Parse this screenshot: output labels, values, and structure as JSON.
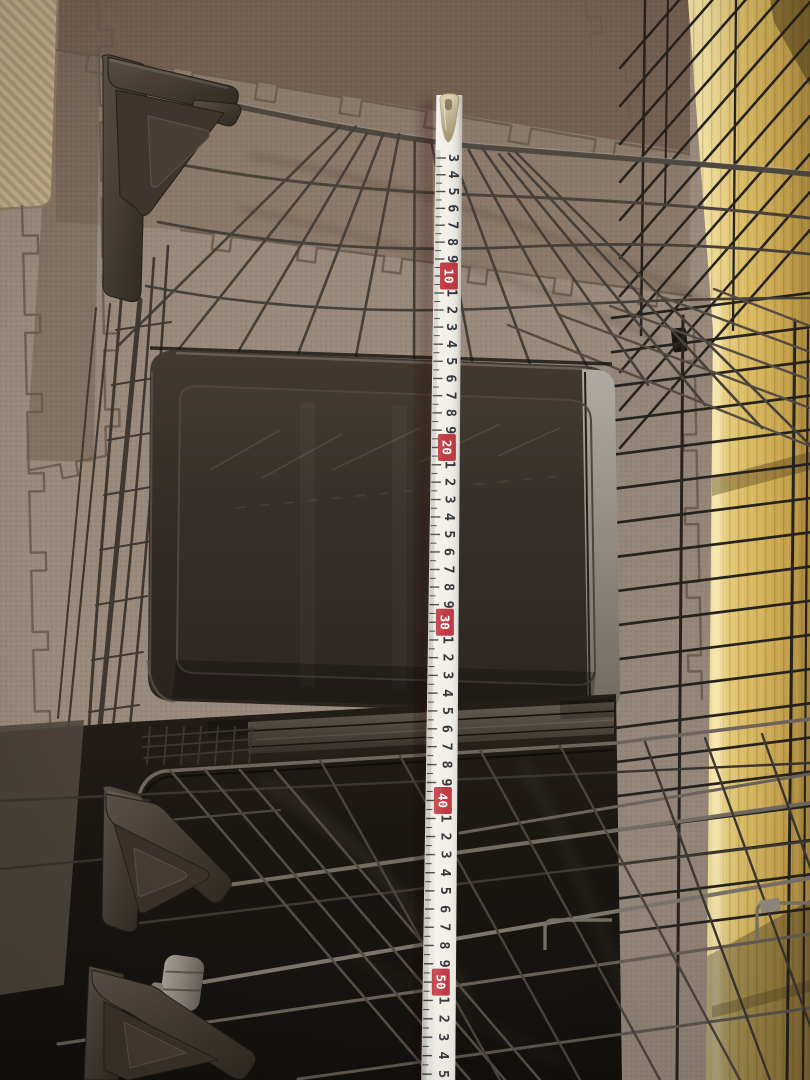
{
  "scene": {
    "kind": "photo",
    "objects": [
      "wire-pet-cage",
      "plastic-litter-tray",
      "folding-measuring-tape",
      "foam-puzzle-mats",
      "wood-panel"
    ]
  },
  "palette": {
    "mat_base": "#998a7b",
    "mat_mid": "#8b7a69",
    "mat_dark": "#746050",
    "mat_seam": "#6a5b4e",
    "woven_mat": "#c0ab89",
    "wood_light": "#f1e0a2",
    "wood_mid": "#d9ba62",
    "wood_dark": "#b3913f",
    "wire_brown": "#4f4840",
    "wire_black": "#26231f",
    "wire_metal": "#7d756a",
    "bracket_plastic": "#453b32",
    "tray_dark": "#332c26",
    "tray_edge_light": "#a8a399",
    "lower_gloss": "#1b1713",
    "tape_white": "#f3f0e9",
    "tape_red": "#c03a42",
    "tape_digit": "#35343a",
    "tape_decade_digit": "#ffffff",
    "tape_tick": "#45423c",
    "tape_tip_metal": "#c9bc98"
  },
  "tape": {
    "marks": [
      {
        "cm": 3,
        "label": "3",
        "decade": false
      },
      {
        "cm": 4,
        "label": "4",
        "decade": false
      },
      {
        "cm": 5,
        "label": "5",
        "decade": false
      },
      {
        "cm": 6,
        "label": "6",
        "decade": false
      },
      {
        "cm": 7,
        "label": "7",
        "decade": false
      },
      {
        "cm": 8,
        "label": "8",
        "decade": false
      },
      {
        "cm": 9,
        "label": "9",
        "decade": false
      },
      {
        "cm": 10,
        "label": "10",
        "decade": true
      },
      {
        "cm": 11,
        "label": "1",
        "decade": false
      },
      {
        "cm": 12,
        "label": "2",
        "decade": false
      },
      {
        "cm": 13,
        "label": "3",
        "decade": false
      },
      {
        "cm": 14,
        "label": "4",
        "decade": false
      },
      {
        "cm": 15,
        "label": "5",
        "decade": false
      },
      {
        "cm": 16,
        "label": "6",
        "decade": false
      },
      {
        "cm": 17,
        "label": "7",
        "decade": false
      },
      {
        "cm": 18,
        "label": "8",
        "decade": false
      },
      {
        "cm": 19,
        "label": "9",
        "decade": false
      },
      {
        "cm": 20,
        "label": "20",
        "decade": true
      },
      {
        "cm": 21,
        "label": "1",
        "decade": false
      },
      {
        "cm": 22,
        "label": "2",
        "decade": false
      },
      {
        "cm": 23,
        "label": "3",
        "decade": false
      },
      {
        "cm": 24,
        "label": "4",
        "decade": false
      },
      {
        "cm": 25,
        "label": "5",
        "decade": false
      },
      {
        "cm": 26,
        "label": "6",
        "decade": false
      },
      {
        "cm": 27,
        "label": "7",
        "decade": false
      },
      {
        "cm": 28,
        "label": "8",
        "decade": false
      },
      {
        "cm": 29,
        "label": "9",
        "decade": false
      },
      {
        "cm": 30,
        "label": "30",
        "decade": true
      },
      {
        "cm": 31,
        "label": "1",
        "decade": false
      },
      {
        "cm": 32,
        "label": "2",
        "decade": false
      },
      {
        "cm": 33,
        "label": "3",
        "decade": false
      },
      {
        "cm": 34,
        "label": "4",
        "decade": false
      },
      {
        "cm": 35,
        "label": "5",
        "decade": false
      },
      {
        "cm": 36,
        "label": "6",
        "decade": false
      },
      {
        "cm": 37,
        "label": "7",
        "decade": false
      },
      {
        "cm": 38,
        "label": "8",
        "decade": false
      },
      {
        "cm": 39,
        "label": "9",
        "decade": false
      },
      {
        "cm": 40,
        "label": "40",
        "decade": true
      },
      {
        "cm": 41,
        "label": "1",
        "decade": false
      },
      {
        "cm": 42,
        "label": "2",
        "decade": false
      },
      {
        "cm": 43,
        "label": "3",
        "decade": false
      },
      {
        "cm": 44,
        "label": "4",
        "decade": false
      },
      {
        "cm": 45,
        "label": "5",
        "decade": false
      },
      {
        "cm": 46,
        "label": "6",
        "decade": false
      },
      {
        "cm": 47,
        "label": "7",
        "decade": false
      },
      {
        "cm": 48,
        "label": "8",
        "decade": false
      },
      {
        "cm": 49,
        "label": "9",
        "decade": false
      },
      {
        "cm": 50,
        "label": "50",
        "decade": true
      },
      {
        "cm": 51,
        "label": "1",
        "decade": false
      },
      {
        "cm": 52,
        "label": "2",
        "decade": false
      },
      {
        "cm": 53,
        "label": "3",
        "decade": false
      },
      {
        "cm": 54,
        "label": "4",
        "decade": false
      },
      {
        "cm": 55,
        "label": "5",
        "decade": false
      }
    ]
  }
}
